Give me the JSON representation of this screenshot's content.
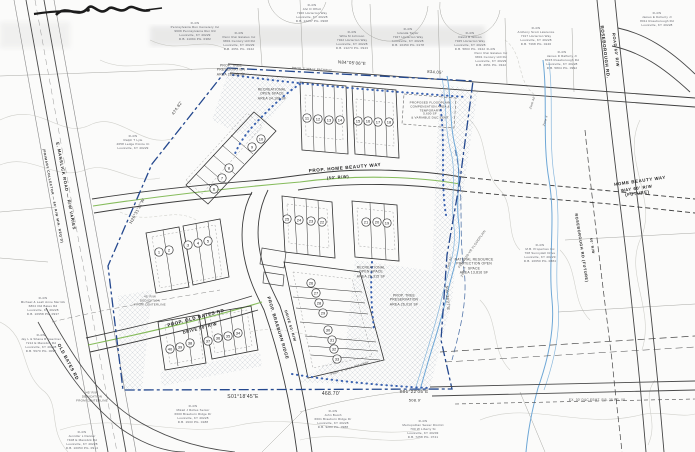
{
  "roads": {
    "manslick_line1": "E. MANSLICK ROAD — R/W VARIES",
    "manslick_line2": "(PRIMARY COLLECTOR — 80' R/W MIN. REQ'D)",
    "old_bates_existing": "OLD BATES RD",
    "prop_old_bates_line1": "PROP. OLD BATES RD",
    "prop_old_bates_line2": "DRIVE 60' R/W",
    "braeburn_line1": "PROP. BRAEBURN RIDGE",
    "braeburn_line2": "DRIVE 50' R/W",
    "home_beauty_line1": "PROP. HOME BEAUTY WAY",
    "home_beauty_line2": "(50' R/W)",
    "home_beauty_future_line1": "HOME BEAUTY WAY",
    "home_beauty_future_line2": "WAY 60' R/W (FUTURE)",
    "roseborough_line1": "ROSEBOROUGH RD.",
    "roseborough_line2": "ROAD 60' R/W",
    "roseborough_future_line1": "ROSEBOROUGH RD (FUTURE)",
    "roseborough_future_line2": "50' R/W"
  },
  "bearings": {
    "north": "N84°05'06\"E",
    "north_dim": "834.05'",
    "west_dim": "474.82'",
    "west": "N26°31'11\"W",
    "south1": "S01°18'45\"E",
    "south_dim": "468.70'",
    "south2": "S01°22'05\"E",
    "south2_dim": "508.9'",
    "east": "S01°38'27\"E"
  },
  "areas": {
    "tree_preservation_north": "PROP. TREE\nPRESERVATION\nAREA 26,198 SF",
    "rec_open_space_north": "RECREATIONAL\nOPEN SPACE\nAREA 34,108 SF",
    "rec_open_space_mid": "RECREATIONAL\nOPEN SPACE\nAREA 26,315 SF",
    "tree_preservation_mid": "PROP. TREE\nPRESERVATION\nAREA 26,010 SF",
    "natural_resource": "NATURAL RESOURCE\nPROTECTION OPEN\nSPACE\nAREA 13,816 SF"
  },
  "notes": {
    "walk_path_north": "PROP. 5' WALK PATHWAY",
    "walk_path_south": "PROP. 5' WALK PATHWAY",
    "fema": "FEMA 100-YR FLOODPLAIN",
    "zone_ae": "Zone AE",
    "zone_x": "Zone X",
    "dedication": "45' R/W\nDEDICATION\nFROM CENTERLINE",
    "esmt": "EX. 30' D&C ESMT. P.B. 38 PG. 08",
    "floodplain_comp": "PROPOSED FLOODPLAIN\nCOMPENSATION AREA &\nTEMPORARY\n5,600 SF\n& VARIABLE D&C ESMT"
  },
  "owners": {
    "penn_cemetery": "R-4/N\nPennsylvania Run Cemetery Inc\n9609 Pennsylvania Run Rd\nLouisville, KY 40229\nD.B. 11094 PG. 0382",
    "lyle": "R-4/N\nRalph T Lyle\n4658 Ledge Pointe Ct\nLouisville, KY 40229",
    "offutt": "R-4/N\nAlvi D Offutt\n7320 Horterton Way\nLouisville, KY 40228\nD.B. 12237 PG. 0968",
    "penn_run_w": "R-4/N\nPenn Run Estates Inc\n9801 Century Hill Rd\nLouisville, KY 40229\nD.B. 4651 PG. 0342",
    "johnson": "R-4/N\nWilla M Johnson\n7322 Horterton Way\nLouisville, KY 40228\nD.B. 13273 PG. 0943",
    "taylor": "R-4/N\nIolanda Taylor\n7327 Horterton Way\nLouisville, KY 40228\nD.B. 10450 PG. 0178",
    "wilson": "R-4/N\nDavid B Wilson\n7325 Horterton Way\nLouisville, KY 40228\nD.B. 5803 PG. 0342",
    "lawrence": "R-4/N\nAnthony Scott Lawrence\n7317 Horterton Way\nLouisville, KY 40228\nD.B. 7368 PG. 0246",
    "doherty": "R-4/N\nJames E Doherty Jr\n8011 Roseborough Rd\nLouisville, KY 40228",
    "rafferty": "R-4/N\nJames D Rafferty Jr\n8015 Roseborough Rd\nLouisville, KY 40228\nD.B. 5804 PG. 0992",
    "penn_run_e": "R-4/N\nPenn Run Estates Inc\n9801 Century Hill Rd\nLouisville, KY 40229\nD.B. 4651 PG. 0342",
    "mb_properties": "R-4/N\nM.B. Properties Inc\n708 Sunnydell Drive\nLouisville, KY 40229\nD.B. 10650 PG. 0884",
    "merrick": "R-4/N\nMichael & Leah Anne Merrick\n6804 Old Bates Rd\nLouisville, KY 40228\nD.B. 10958 PG. 0937",
    "gaertner": "R-4/N\nJay L & Shana R Gaertner\n7212 E Manslick Rd\nLouisville, KY 40228\nD.B. 5970 PG. 0092",
    "danner": "R-4/N\nJennifer L Danner\n7408 E Manslick Rd\nLouisville, KY 40228\nD.B. 10053 PG. 0914",
    "rolles": "R-4/N\nMikail J Rolles Senior\n6600 Braeburn Ridge Dr\nLouisville, KY 40228\nD.B. 1933 PG. 0188",
    "booth": "R-4/N\nJohn Booth\n6601 Braeburn Ridge Dr\nLouisville, KY 40228\nD.B. 9283 PG. 0988",
    "msd": "R-4/N\nMetropolitan Sewer District\n700 W Liberty St\nLouisville, KY 40203\nD.B. 7258 PG. 0741"
  },
  "lots": [
    "1",
    "2",
    "3",
    "4",
    "5",
    "6",
    "7",
    "8",
    "9",
    "10",
    "11",
    "12",
    "13",
    "14",
    "15",
    "16",
    "17",
    "18",
    "19",
    "20",
    "21",
    "22",
    "23",
    "24",
    "25",
    "26",
    "27",
    "28",
    "29",
    "30",
    "31",
    "32",
    "33",
    "34",
    "35",
    "36",
    "37",
    "38",
    "39",
    "40"
  ]
}
